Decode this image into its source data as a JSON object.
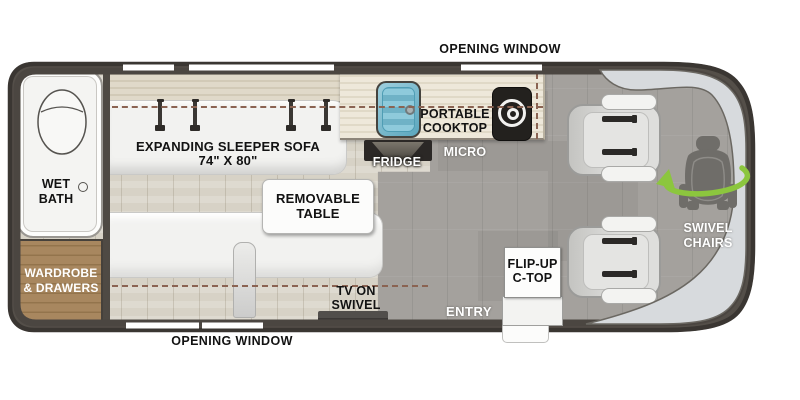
{
  "diagram": {
    "type": "rv-floor-plan",
    "windows": {
      "top_label": "OPENING WINDOW",
      "bottom_label": "OPENING WINDOW"
    },
    "areas": {
      "wet_bath": {
        "label": "WET\nBATH"
      },
      "wardrobe": {
        "label": "WARDROBE\n& DRAWERS"
      },
      "sleeper_sofa": {
        "label": "EXPANDING SLEEPER SOFA\n74\" X 80\""
      },
      "removable_table": {
        "label": "REMOVABLE\nTABLE"
      },
      "portable_cooktop": {
        "label": "PORTABLE\nCOOKTOP"
      },
      "fridge": {
        "label": "FRIDGE"
      },
      "micro": {
        "label": "MICRO"
      },
      "tv": {
        "label": "TV ON\nSWIVEL"
      },
      "entry": {
        "label": "ENTRY"
      },
      "flip_up_counter": {
        "label": "FLIP-UP\nC-TOP"
      },
      "swivel_chairs": {
        "label": "SWIVEL\nCHAIRS"
      }
    },
    "colors": {
      "wall": "#544f49",
      "outline": "#3a3632",
      "wood_floor": "#d7d2c6",
      "vinyl_floor": "#a4a19d",
      "counter": "#ebe5d6",
      "cabinet_wood": "#a8875f",
      "sink_blue": "#79b9cd",
      "swivel_arrow_green": "#8cc63e",
      "windshield_silver": "#d7dadd"
    }
  }
}
